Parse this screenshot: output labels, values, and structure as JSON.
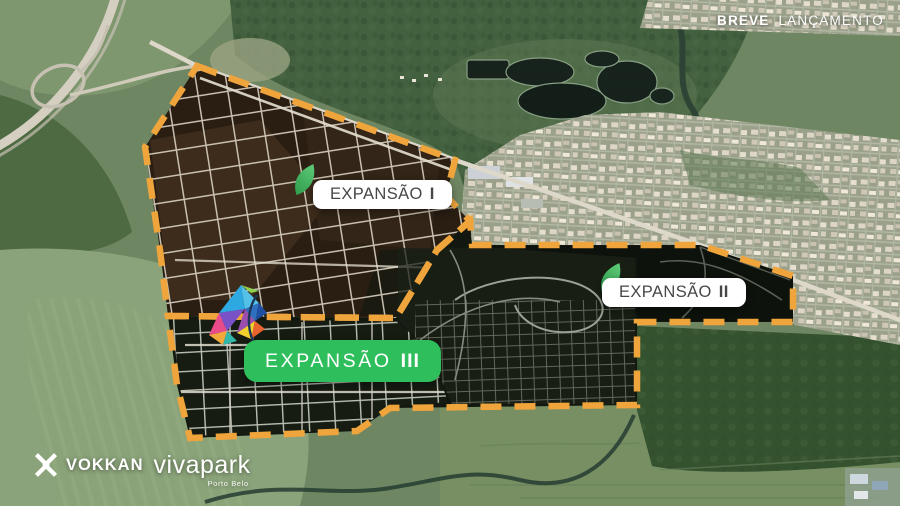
{
  "teaser": {
    "bold": "BREVE",
    "regular": "LANÇAMENTO"
  },
  "regions": [
    {
      "id": "expansao-1",
      "word": "EXPANSÃO",
      "numeral": "I"
    },
    {
      "id": "expansao-2",
      "word": "EXPANSÃO",
      "numeral": "II"
    },
    {
      "id": "expansao-3",
      "word": "EXPANSÃO",
      "numeral": "III"
    }
  ],
  "brand": {
    "company": "VOKKAN",
    "product": "vivapark",
    "location": "Porto Belo"
  },
  "colors": {
    "boundary_orange": "#EFA53C",
    "pill_green": "#2FBE5C",
    "leaf_green": "#3BAE5C",
    "label_text_dark": "#474747",
    "overlay_text_white": "#FFFFFF"
  },
  "icons": {
    "region_marker": "leaf-icon",
    "brand_mark": "vokkan-x-icon",
    "decoration": "butterfly-graphic"
  }
}
